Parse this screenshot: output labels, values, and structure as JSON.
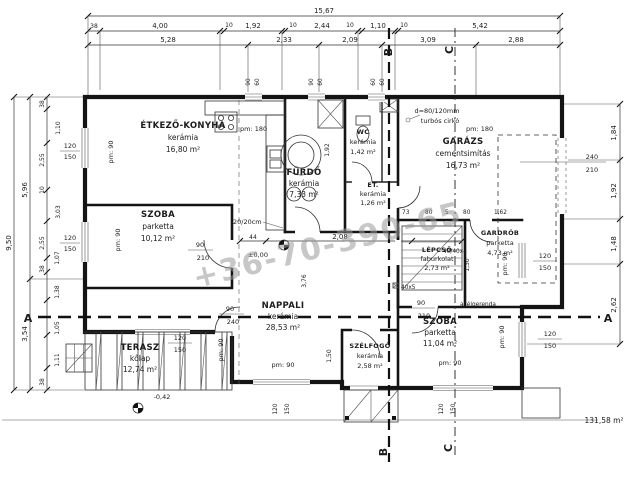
{
  "title": {
    "total_area": "131,58 m²",
    "watermark": "+36-70-390-65"
  },
  "rooms": [
    {
      "name": "ÉTKEZŐ-KONYHA",
      "material": "kerámia",
      "area": "16,80 m²"
    },
    {
      "name": "SZOBA",
      "material": "parketta",
      "area": "10,12 m²"
    },
    {
      "name": "FÜRDŐ",
      "material": "kerámia",
      "area": "7,33 m²"
    },
    {
      "name": "WC",
      "material": "kerámia",
      "area": "1,42 m²"
    },
    {
      "name": "ET.",
      "material": "kerámia",
      "area": "1,26 m²"
    },
    {
      "name": "GARÁZS",
      "material": "cementsimítás",
      "area": "16,73 m²"
    },
    {
      "name": "LÉPCSŐ",
      "material": "faburkolat",
      "area": "2,73 m²"
    },
    {
      "name": "GARDRÓB",
      "material": "parketta",
      "area": "4,73 m²"
    },
    {
      "name": "NAPPALI",
      "material": "kerámia",
      "area": "28,53 m²"
    },
    {
      "name": "SZÉLFOGÓ",
      "material": "kerámia",
      "area": "2,58 m²"
    },
    {
      "name": "SZOBA",
      "material": "parketta",
      "area": "11,04 m²"
    },
    {
      "name": "TERASZ",
      "material": "kőlap",
      "area": "12,74 m²"
    }
  ],
  "dims": {
    "overall_w": "15,67",
    "top2": [
      "38",
      "4,00",
      "10",
      "1,92",
      "10",
      "2,44",
      "10",
      "1,10",
      "10",
      "5,42"
    ],
    "top3": [
      "5,28",
      "2,33",
      "2,09",
      "3,09",
      "2,88"
    ],
    "left1": "9,50",
    "left2": [
      "5,96",
      "3,54"
    ],
    "left3": [
      "38",
      "1,10",
      "2,55",
      "10",
      "3,03",
      "2,55",
      "1,07",
      "38",
      "1,38",
      "1,05",
      "1,11",
      "38"
    ],
    "right": [
      "1,84",
      "1,92",
      "1,48",
      "2,62"
    ],
    "stairs_row": [
      "73",
      "80",
      "5",
      "80",
      "1,62"
    ],
    "inner": {
      "a": "44",
      "b": "2,08",
      "c": "3,76",
      "d": "1,92",
      "e": "1,50",
      "f": "1,30"
    }
  },
  "open": {
    "w120": "120",
    "w150": "150",
    "w90": "90",
    "w60": "60",
    "d210": "210",
    "d240": "240"
  },
  "pm": {
    "h180": "pm: 180",
    "h90": "pm: 90"
  },
  "levels": {
    "zero": "±0,00",
    "terrace": "-0,42"
  },
  "notes": {
    "chimney1": "d=80/120mm",
    "chimney2": "turbós cirkó",
    "wall": "20/20cm",
    "steel": "acélgerenda",
    "post": "40x5",
    "post2": "40/40x4"
  },
  "sections": {
    "a": "A",
    "b": "B",
    "c": "C"
  }
}
